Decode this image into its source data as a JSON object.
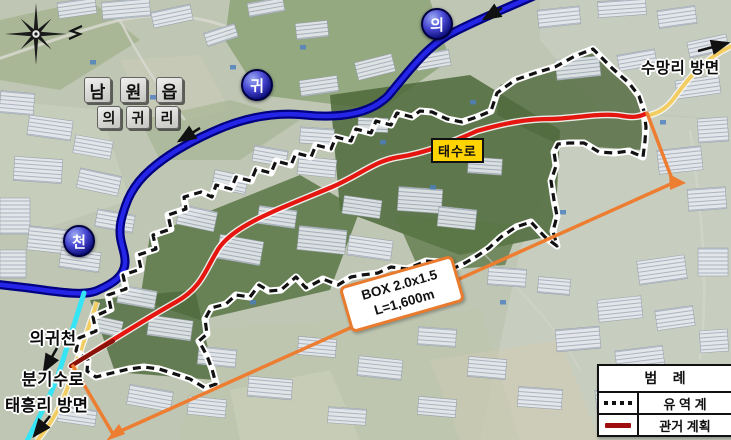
{
  "map": {
    "town_label": {
      "chars": [
        "남",
        "원",
        "읍"
      ]
    },
    "village_label": {
      "chars": [
        "의",
        "귀",
        "리"
      ]
    },
    "stream_badges": {
      "b1": "의",
      "b2": "귀",
      "b3": "천"
    },
    "road_badge": {
      "label": "태수로"
    },
    "directions": {
      "sumangri": "수망리 방면",
      "taeheungri": "태흥리 방면",
      "branch_line1": "의귀천",
      "branch_line2": "분기수로"
    },
    "box_callout": {
      "line1": "BOX 2.0x1.5",
      "line2": "L=1,600m"
    },
    "legend": {
      "title": "범    례",
      "items": [
        {
          "symbol": "dashed-black-line",
          "label": "유 역 계"
        },
        {
          "symbol": "solid-darkred-line",
          "label": "관거 계획"
        }
      ]
    },
    "colors": {
      "watershed_boundary": "#111111",
      "pipe_plan": "#e51510",
      "pipe_plan_dark": "#8b1208",
      "pipe_plan_legend": "#a00d0d",
      "stream": "#2525e8",
      "stream_casing": "#000080",
      "branch_channel": "#35e5f5",
      "plan_channel": "#ed7d31",
      "road": "#f2cd62",
      "road_badge_bg": "#ffd400"
    }
  }
}
